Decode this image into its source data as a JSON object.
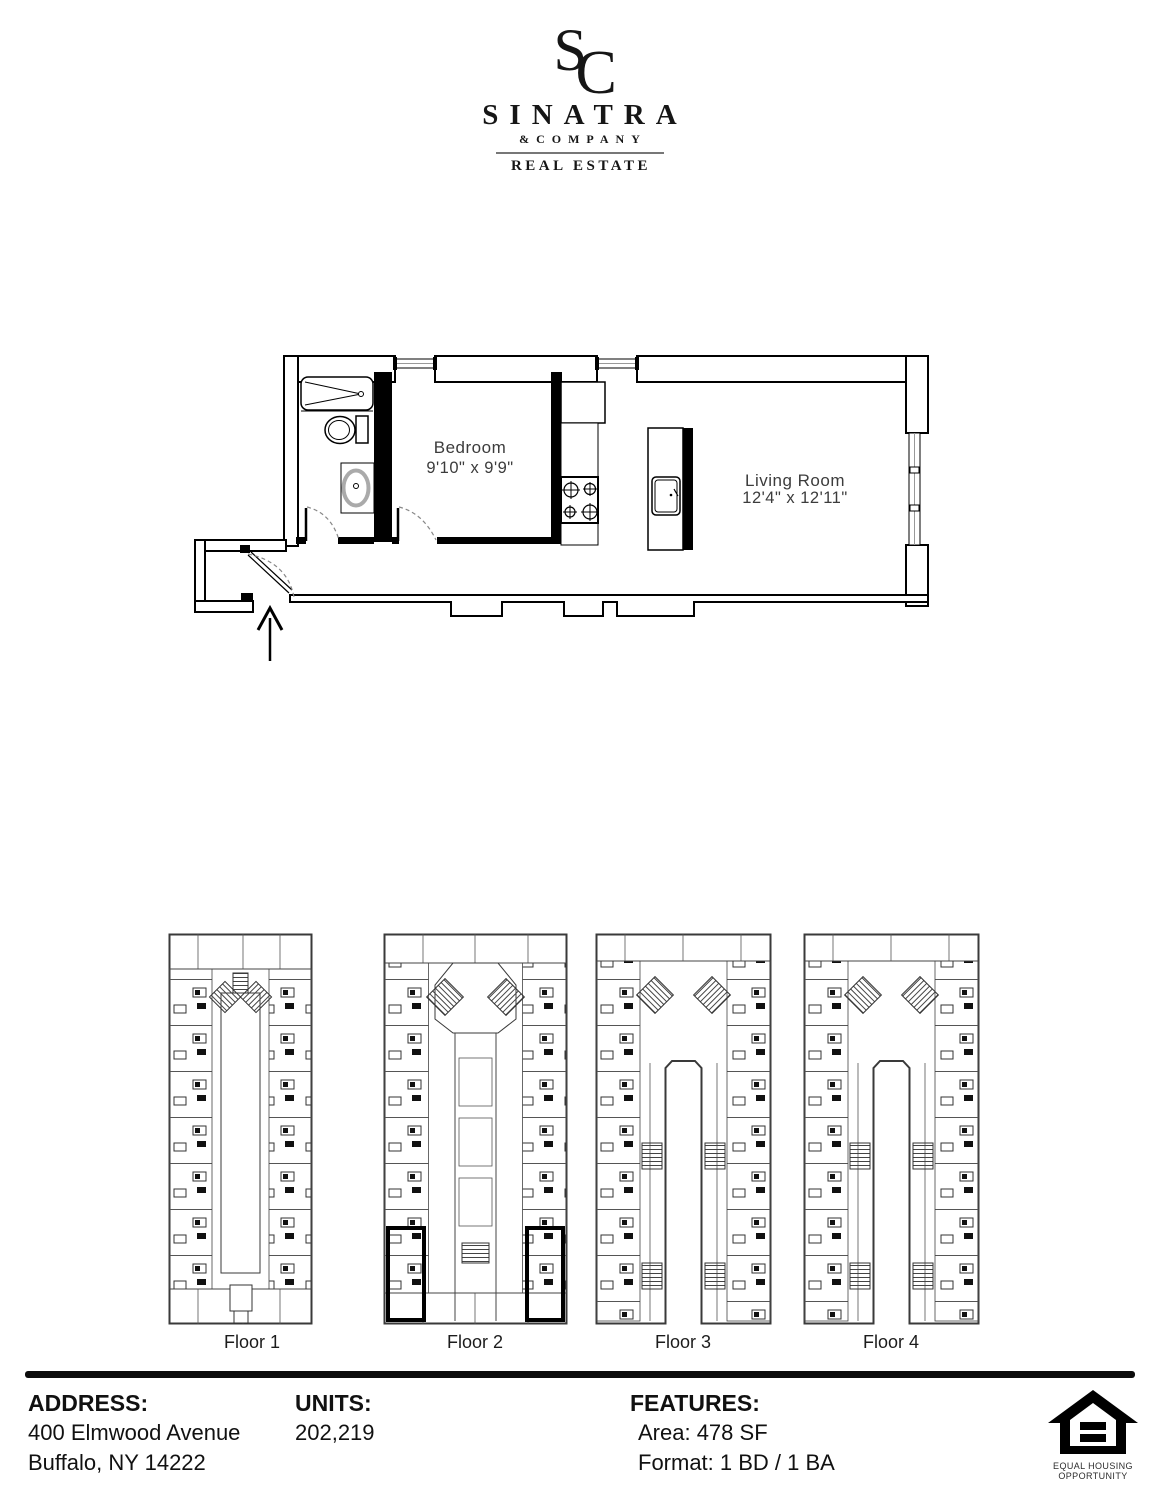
{
  "brand": {
    "monogram_s": "S",
    "monogram_c": "C",
    "name": "SINATRA",
    "subname": "&COMPANY",
    "tagline": "REAL ESTATE"
  },
  "unit_plan": {
    "bedroom": {
      "label": "Bedroom",
      "dims": "9'10\" x 9'9\""
    },
    "living_room": {
      "label": "Living Room",
      "dims": "12'4\" x 12'11\""
    }
  },
  "floors": [
    {
      "label": "Floor 1"
    },
    {
      "label": "Floor 2"
    },
    {
      "label": "Floor 3"
    },
    {
      "label": "Floor 4"
    }
  ],
  "footer": {
    "address": {
      "heading": "ADDRESS:",
      "line1": "400 Elmwood Avenue",
      "line2": "Buffalo, NY 14222"
    },
    "units": {
      "heading": "UNITS:",
      "value": "202,219"
    },
    "features": {
      "heading": "FEATURES:",
      "area": "Area: 478 SF",
      "format": "Format: 1 BD / 1 BA"
    },
    "eho": {
      "line1": "EQUAL HOUSING",
      "line2": "OPPORTUNITY"
    }
  },
  "colors": {
    "ink": "#161616",
    "wall": "#000000",
    "grayline": "#999999"
  }
}
